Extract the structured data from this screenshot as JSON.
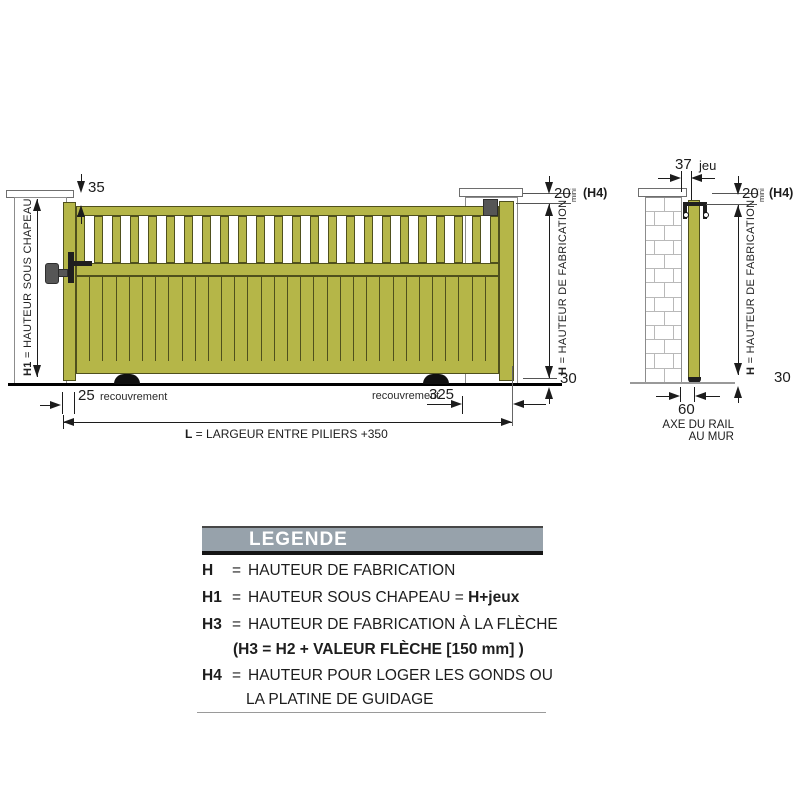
{
  "diagram": {
    "front_view": {
      "h1_label": {
        "prefix": "H1",
        "rest": " = HAUTEUR SOUS CHAPEAU"
      },
      "h_label": {
        "prefix": "H",
        "rest": " = HAUTEUR DE FABRICATION"
      },
      "dim_top_gap": "35",
      "dim_h4_value": "20",
      "dim_h4_unit": "mini",
      "dim_h4_ref": "(H4)",
      "dim_bottom_gap": "30",
      "dim_overlap_left_value": "25",
      "dim_overlap_left_label": "recouvrement",
      "dim_overlap_right_label": "recouvrement",
      "dim_overlap_right_value": "325",
      "dim_length": {
        "prefix": "L",
        "rest": " = LARGEUR ENTRE PILIERS +350"
      }
    },
    "side_view": {
      "dim_clearance_value": "37",
      "dim_clearance_label": "jeu",
      "dim_h4_value": "20",
      "dim_h4_unit": "mini",
      "dim_h4_ref": "(H4)",
      "h_label": {
        "prefix": "H",
        "rest": " = HAUTEUR DE FABRICATION"
      },
      "dim_bottom_gap": "30",
      "dim_rail_offset": "60",
      "rail_axis_label_line1": "AXE DU RAIL",
      "rail_axis_label_line2": "AU MUR"
    },
    "gate": {
      "baluster_count": 24,
      "board_count": 32,
      "brick_rows": 13
    },
    "colors": {
      "gate_fill": "#b5b648",
      "gate_stroke": "#4f501d",
      "hardware_gray": "#565656",
      "hardware_dark": "#1f1f1f",
      "dim_color": "#1c1c1c",
      "pillar_stroke": "#8c8c8c",
      "brick_line": "#b9b9b9",
      "legend_bar_fill": "#97a2ab"
    }
  },
  "legend": {
    "title": "LEGENDE",
    "rows": [
      {
        "term": "H",
        "eq": "=",
        "text": "HAUTEUR DE FABRICATION",
        "bold": ""
      },
      {
        "term": "H1",
        "eq": "=",
        "text": "HAUTEUR SOUS CHAPEAU = ",
        "bold": "H+jeux"
      },
      {
        "term": "H3",
        "eq": "=",
        "text": "HAUTEUR DE FABRICATION À LA FLÈCHE",
        "bold": ""
      },
      {
        "term": "",
        "eq": "",
        "text": "",
        "bold": "(H3 = H2 + VALEUR FLÈCHE [150 mm] )"
      },
      {
        "term": "H4",
        "eq": "=",
        "text": "HAUTEUR POUR LOGER LES GONDS OU",
        "bold": ""
      },
      {
        "term": "",
        "eq": "",
        "text": "LA PLATINE DE GUIDAGE",
        "bold": ""
      }
    ]
  }
}
